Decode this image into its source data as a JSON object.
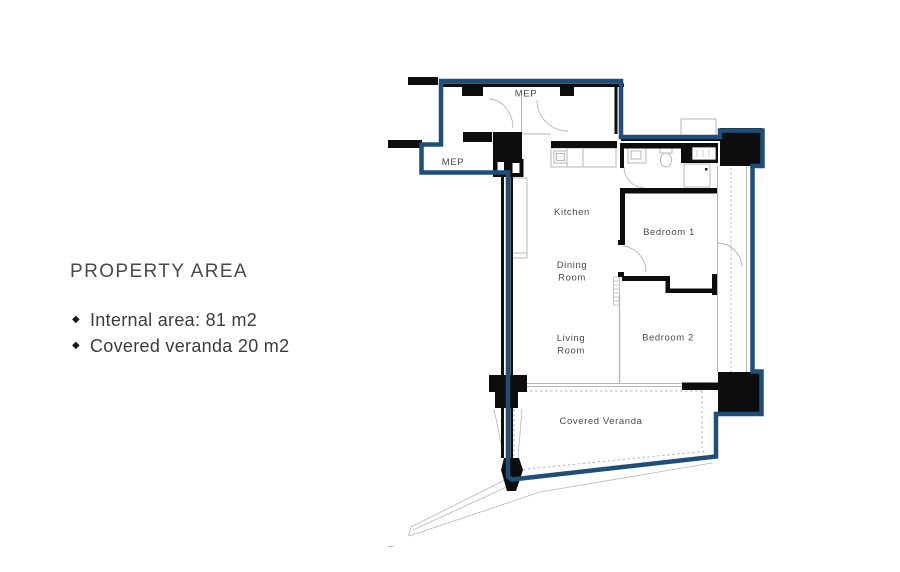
{
  "property_area": {
    "title": "PROPERTY AREA",
    "bullet_icon": "◆",
    "items": [
      {
        "label": "Internal area: 81 m2"
      },
      {
        "label": "Covered veranda 20 m2"
      }
    ]
  },
  "floor_plan": {
    "labels": {
      "mep_upper": "MEP",
      "mep_lower": "MEP",
      "kitchen": "Kitchen",
      "dining": {
        "line1": "Dining",
        "line2": "Room"
      },
      "living": {
        "line1": "Living",
        "line2": "Room"
      },
      "bedroom1": "Bedroom 1",
      "bedroom2": "Bedroom 2",
      "veranda": "Covered Veranda"
    },
    "colors": {
      "boundary_blue": "#1f4e79",
      "wall_black": "#0d0d0d",
      "interior_gray": "#b7b7b7",
      "label_gray": "#4b4b4b"
    }
  }
}
